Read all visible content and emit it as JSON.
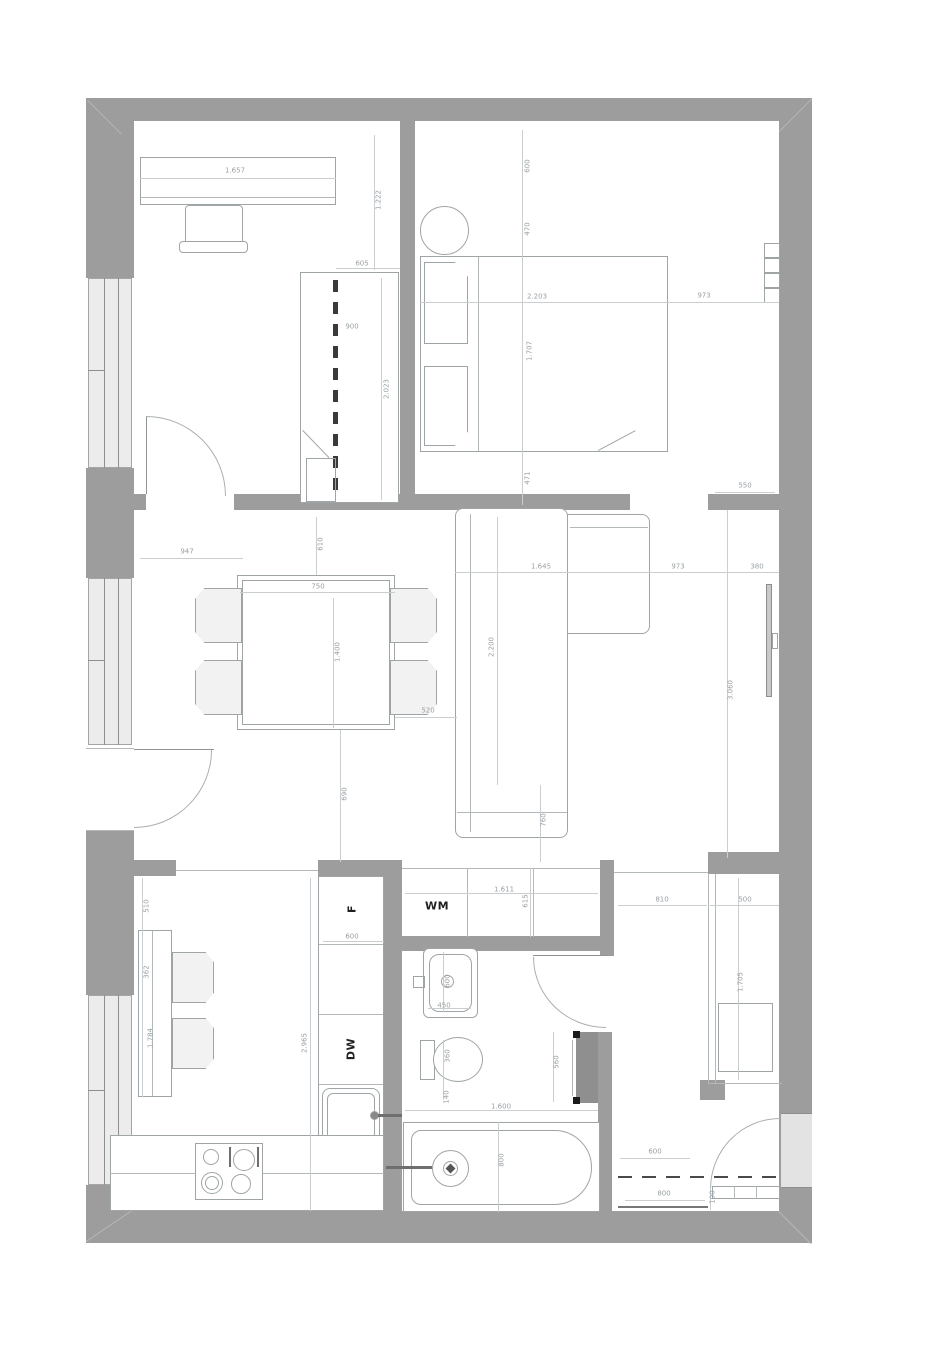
{
  "title": "apartment-floor-plan",
  "colors": {
    "wall": "#9d9d9d",
    "window_fill": "#ececec",
    "furniture_line": "#9fa5a7",
    "dimension_line": "#cbced0",
    "dimension_text": "#9aa0a4",
    "label_text": "#1f1f1f",
    "radiator_fill": "#8f8f8f",
    "dash_color": "#3a3a3a"
  },
  "labels": {
    "washing_machine": "WM",
    "fridge": "F",
    "dishwasher": "DW"
  },
  "dims": {
    "office_desk_width": "1.657",
    "office_right_depth": "1.222",
    "wardrobe_gap": "605",
    "wardrobe_width": "900",
    "wardrobe_height": "2.023",
    "bedroom_top": "600",
    "bedroom_upper": "470",
    "bed_length": "2.203",
    "bed_to_wall": "973",
    "bed_width": "1.707",
    "bed_lower": "471",
    "bedroom_stub": "550",
    "living_entry": "947",
    "table_offset": "610",
    "table_width": "750",
    "table_length": "1.400",
    "sofa_chaise": "1.645",
    "sofa_length": "2.200",
    "living_right": "973",
    "tv_niche": "380",
    "living_height": "3.060",
    "table_to_sofa": "520",
    "table_to_kitchen": "690",
    "sofa_to_bottom": "760",
    "kitchen_top": "510",
    "kitchen_mid": "362",
    "kitchen_table": "1.784",
    "kitchen_depth": "2.965",
    "fridge_width": "600",
    "wm_niche_width": "1.611",
    "wm_niche_depth": "615",
    "basin_width": "600",
    "basin_depth": "450",
    "wc_width": "360",
    "wc_gap": "140",
    "radiator_height": "560",
    "bathtub_length": "1.600",
    "bathtub_width": "800",
    "hall_opening": "810",
    "closet_width": "500",
    "closet_height": "1.705",
    "entrance_offset": "600",
    "entrance_width": "800",
    "door_leaf": "100"
  }
}
